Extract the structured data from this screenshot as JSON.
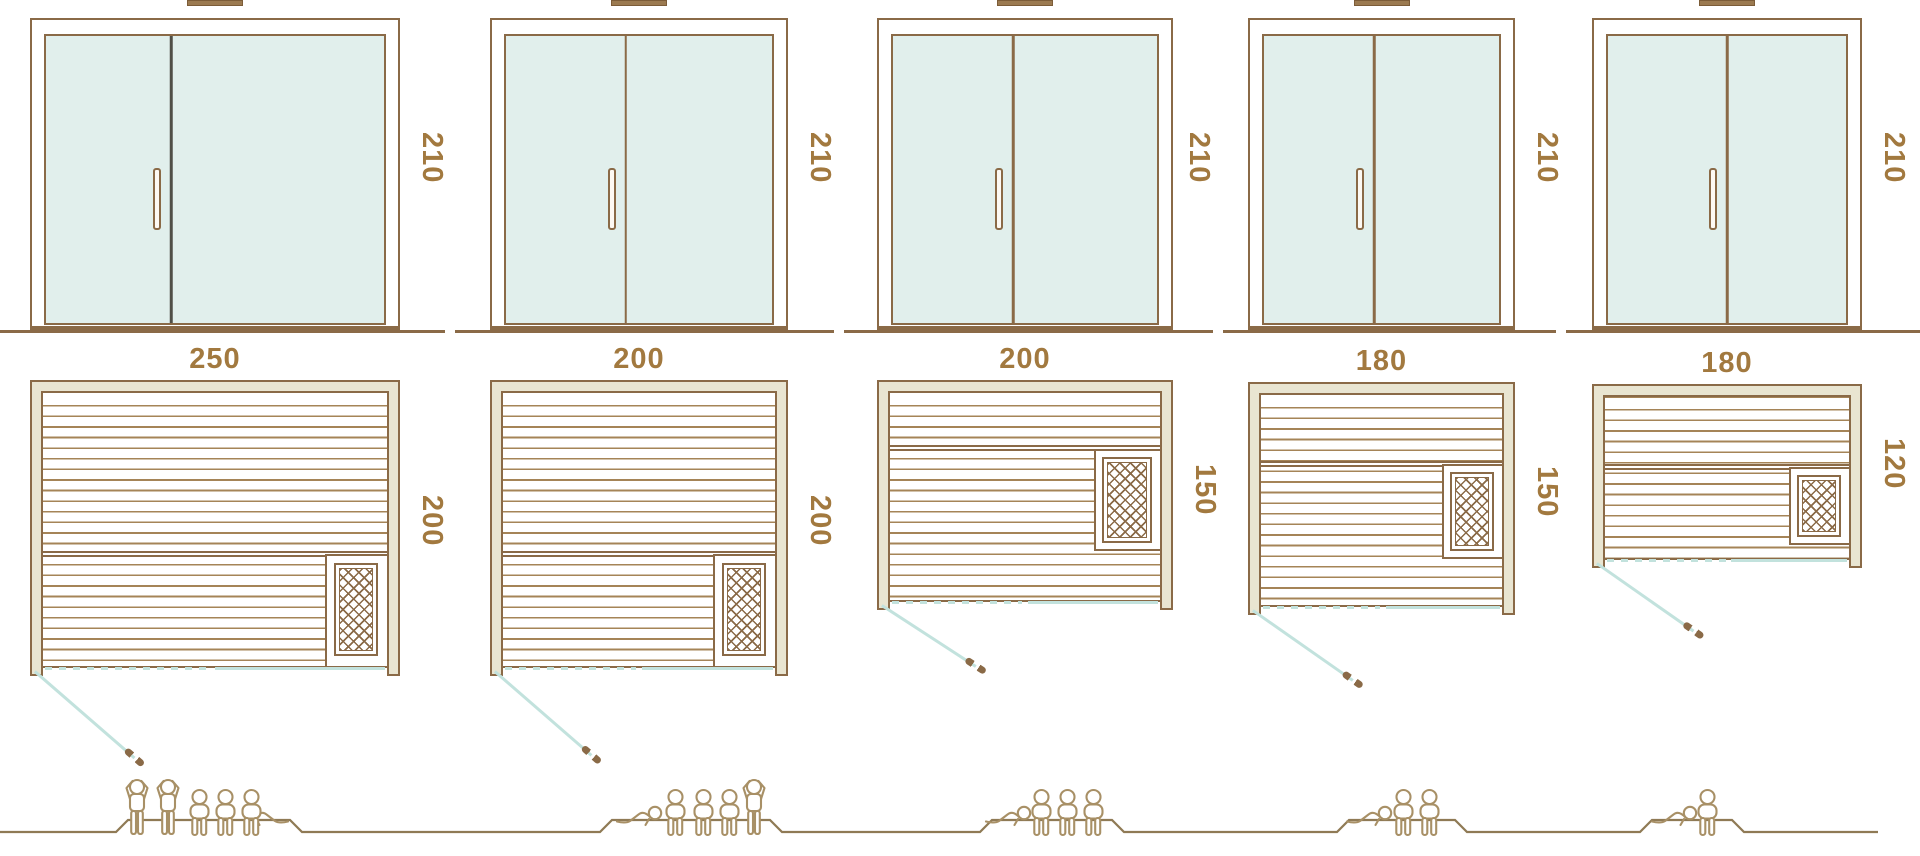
{
  "diagram": {
    "subject": "sauna-size-comparison",
    "views": [
      "front-door-elevation",
      "floor-plan",
      "capacity-figures"
    ],
    "colors": {
      "line_brown": "#8a6a47",
      "frame_beige": "#e9e5d1",
      "glass_mint": "#e1efec",
      "swing_teal": "#c2e2dd",
      "label_brown": "#a2793f",
      "figure_tan": "#a89066"
    }
  },
  "columns": [
    {
      "id": "sauna-250x200",
      "door": {
        "height_label": "210"
      },
      "plan": {
        "width_label": "250",
        "depth_label": "200"
      },
      "capacity": {
        "standing": 2,
        "seated": 3,
        "lying": 1,
        "total": 6
      }
    },
    {
      "id": "sauna-200x200",
      "door": {
        "height_label": "210"
      },
      "plan": {
        "width_label": "200",
        "depth_label": "200"
      },
      "capacity": {
        "standing": 1,
        "seated": 3,
        "lying": 1,
        "total": 5
      }
    },
    {
      "id": "sauna-200x150",
      "door": {
        "height_label": "210"
      },
      "plan": {
        "width_label": "200",
        "depth_label": "150"
      },
      "capacity": {
        "standing": 0,
        "seated": 3,
        "lying": 1,
        "total": 4
      }
    },
    {
      "id": "sauna-180x150",
      "door": {
        "height_label": "210"
      },
      "plan": {
        "width_label": "180",
        "depth_label": "150"
      },
      "capacity": {
        "standing": 0,
        "seated": 2,
        "lying": 1,
        "total": 3
      }
    },
    {
      "id": "sauna-180x120",
      "door": {
        "height_label": "210"
      },
      "plan": {
        "width_label": "180",
        "depth_label": "120"
      },
      "capacity": {
        "standing": 0,
        "seated": 1,
        "lying": 1,
        "total": 2
      }
    }
  ]
}
